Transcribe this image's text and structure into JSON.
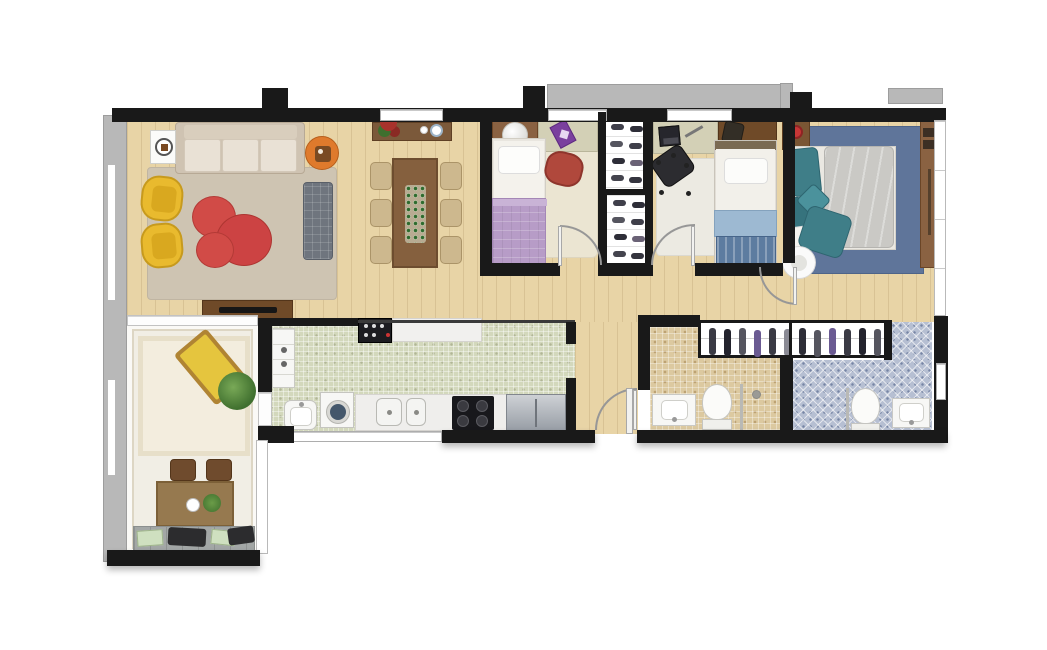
{
  "image_type": "3d-rendered-apartment-floor-plan-top-view",
  "visible_text": [],
  "palette": {
    "bg": "#ffffff",
    "wall": "#191919",
    "ledge": "#b8b8b8",
    "wood": "#e8d4a6",
    "wood-line": "rgba(125,90,45,0.15)",
    "terrace-floor": "#f1eee5",
    "kitchen-tile": "#d3d8bc",
    "bath1-tile": "#dcc9a0",
    "bath2-tile": "#b6bfd2",
    "living-rug": "#cec4b2",
    "sofa-base": "#cfc3b2",
    "sofa-cushion": "#e9e1d5",
    "armchair-yellow": "#e9ba2e",
    "pouf-red": "#d14b47",
    "bench-gray": "#6f757e",
    "side-table-orange": "#df7a2c",
    "wood-furniture": "#8a6242",
    "dark-wood": "#6f4a28",
    "dining-chair": "#cdb88e",
    "bed1-blanket": "#b79cc7",
    "bed1-rug": "#ebe5d2",
    "chair-red": "#b0483c",
    "desk-surface": "#d3d0b6",
    "bed2-blanket-light": "#9db9d2",
    "bed2-blanket-dark": "#5d7ca0",
    "bed2-rug": "#eceae2",
    "office-chair": "#2c2c30",
    "master-rug": "#5f759a",
    "duvet": "#cac9c5",
    "teal": "#3f7e88",
    "lamp-red": "#c73636",
    "white-fixture": "#f7f7f5",
    "plant-green": "#4f7d33",
    "lounge-yellow": "#e5c53e",
    "closet-shoe": "#3f3f4a",
    "garment": "#3a3a44"
  },
  "rooms": [
    {
      "id": "living-room",
      "furniture": [
        "three-seat-sofa",
        "two-yellow-armchairs",
        "red-organic-poufs",
        "area-rug",
        "gray-quilted-bench",
        "orange-side-table",
        "white-side-table",
        "tv-console"
      ]
    },
    {
      "id": "dining-area",
      "furniture": [
        "wood-dining-table",
        "six-beige-chairs",
        "green-table-runner",
        "sideboard-with-flowers-and-plates"
      ]
    },
    {
      "id": "terrace-balcony",
      "furniture": [
        "yellow-lounge-chair",
        "potted-plant",
        "small-dining-table",
        "two-wood-chairs",
        "stone-bench-with-cushions",
        "cream-rug"
      ]
    },
    {
      "id": "kitchen-laundry",
      "furniture": [
        "tall-cabinet",
        "wall-oven",
        "pass-through-counter",
        "laundry-sink",
        "washing-machine",
        "double-sink-counter",
        "four-burner-cooktop",
        "steel-fridge"
      ]
    },
    {
      "id": "bedroom-1",
      "furniture": [
        "single-bed-purple",
        "headboard-desk",
        "sphere-lamp",
        "purple-notebook",
        "red-chair",
        "cream-rug"
      ]
    },
    {
      "id": "shoe-closet",
      "furniture": [
        "two-shoe-racks"
      ]
    },
    {
      "id": "bedroom-2",
      "furniture": [
        "single-bed-blue",
        "desk-with-laptop",
        "black-office-chair",
        "white-rug"
      ]
    },
    {
      "id": "master-bedroom",
      "furniture": [
        "double-bed-gray-duvet",
        "teal-pillows",
        "nightstand-red-lamp",
        "wardrobe",
        "white-pouf",
        "blue-rug"
      ]
    },
    {
      "id": "hallway",
      "furniture": []
    },
    {
      "id": "walk-in-closet",
      "furniture": [
        "hanging-clothes-rail"
      ]
    },
    {
      "id": "bathroom-1",
      "furniture": [
        "vanity-sink",
        "toilet",
        "shower-with-glass-divider"
      ]
    },
    {
      "id": "bathroom-2",
      "furniture": [
        "vanity-sink",
        "toilet",
        "shower-divider"
      ]
    }
  ]
}
